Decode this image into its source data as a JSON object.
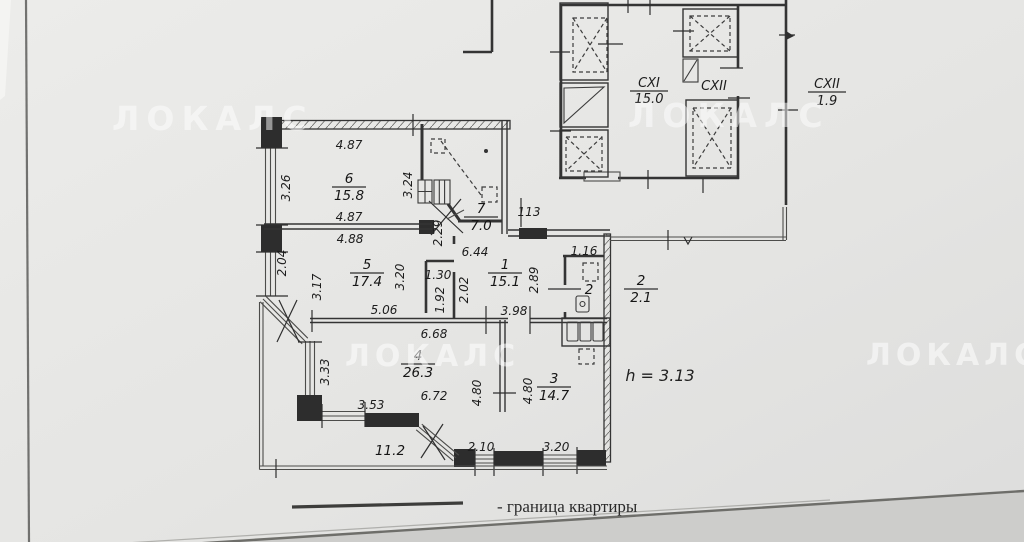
{
  "watermark": {
    "text": "ЛОКАЛС"
  },
  "legend": {
    "label": "- граница квартиры"
  },
  "notes": {
    "ceiling_height": "h = 3.13"
  },
  "common_areas": {
    "cxi": {
      "name": "CXI",
      "area": "15.0"
    },
    "cxii_lobby": {
      "name": "CXII"
    },
    "cxii_balcony": {
      "name": "CXII",
      "area": "1.9"
    }
  },
  "rooms": {
    "r1": {
      "number": "1",
      "area": "15.1"
    },
    "r2": {
      "number": "2",
      "area": "2.1",
      "plan_mark": "2"
    },
    "r3": {
      "number": "3",
      "area": "14.7"
    },
    "r4": {
      "number": "4",
      "area": "26.3"
    },
    "r5": {
      "number": "5",
      "area": "17.4"
    },
    "r6": {
      "number": "6",
      "area": "15.8"
    },
    "r7": {
      "number": "7",
      "area": "7.0"
    },
    "balcony": {
      "area": "11.2"
    }
  },
  "dimensions": {
    "room6_width_top": "4.87",
    "room6_width_bottom": "4.87",
    "room6_depth": "3.26",
    "room5_width_top": "4.88",
    "west_wall_window": "2.04",
    "room5_depth": "3.17",
    "room5_width_bottom": "5.06",
    "room5_height_right": "3.20",
    "room7_depth_left": "3.24",
    "room7_right": "2.29",
    "hall_width_top": "6.44",
    "entry_gap": "113",
    "hall_height_left": "2.02",
    "closet_width": "1.30",
    "closet_height": "1.92",
    "hall_width_bottom": "3.98",
    "hall_height_right": "2.89",
    "bath_width": "1.16",
    "room4_width_top": "6.68",
    "room4_width_bottom": "6.72",
    "room4_height": "4.80",
    "room3_height": "4.80",
    "bay_window_side": "3.33",
    "balcony_window_west": "3.53",
    "balcony_window_south": "2.10",
    "room3_window_south": "3.20"
  }
}
